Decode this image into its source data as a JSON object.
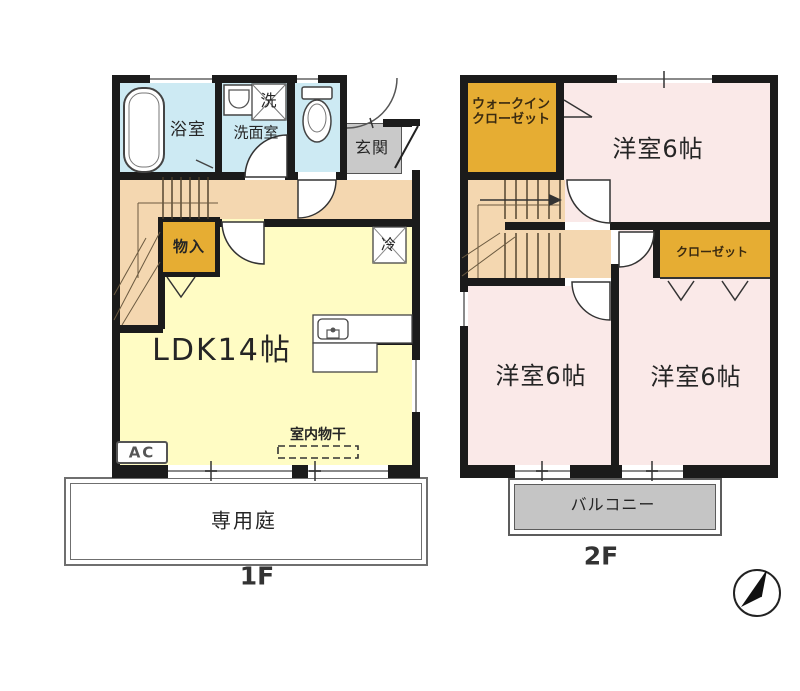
{
  "diagram_type": "japanese-apartment-floor-plan",
  "floors": [
    {
      "label": "1F",
      "rooms": {
        "bath": "浴室",
        "washer_box": "洗",
        "washroom": "洗面室",
        "entrance": "玄関",
        "storage": "物入",
        "ldk": "LDK14帖",
        "fridge": "冷",
        "ac": "AC",
        "indoor_drying": "室内物干",
        "private_garden": "専用庭"
      }
    },
    {
      "label": "2F",
      "rooms": {
        "walkin_closet_line1": "ウォークイン",
        "walkin_closet_line2": "クローゼット",
        "bedroom_top": "洋室6帖",
        "bedroom_bottom_left": "洋室6帖",
        "bedroom_bottom_right": "洋室6帖",
        "closet": "クローゼット",
        "balcony": "バルコニー"
      }
    }
  ],
  "icons": {
    "north_arrow": "north-arrow",
    "bathtub": "bathtub",
    "toilet": "toilet",
    "sink": "sink",
    "kitchen_sink": "kitchen-sink"
  },
  "colors": {
    "wall": "#1b1b1b",
    "wet_room": "#cdeaf3",
    "hallway_stairs": "#f4d7b0",
    "storage_orange": "#e6ad33",
    "ldk_yellow": "#fffcc4",
    "bedroom_pink": "#fae9e8",
    "entrance_gray": "#c9c9c9",
    "balcony_gray": "#c5c5c5"
  }
}
